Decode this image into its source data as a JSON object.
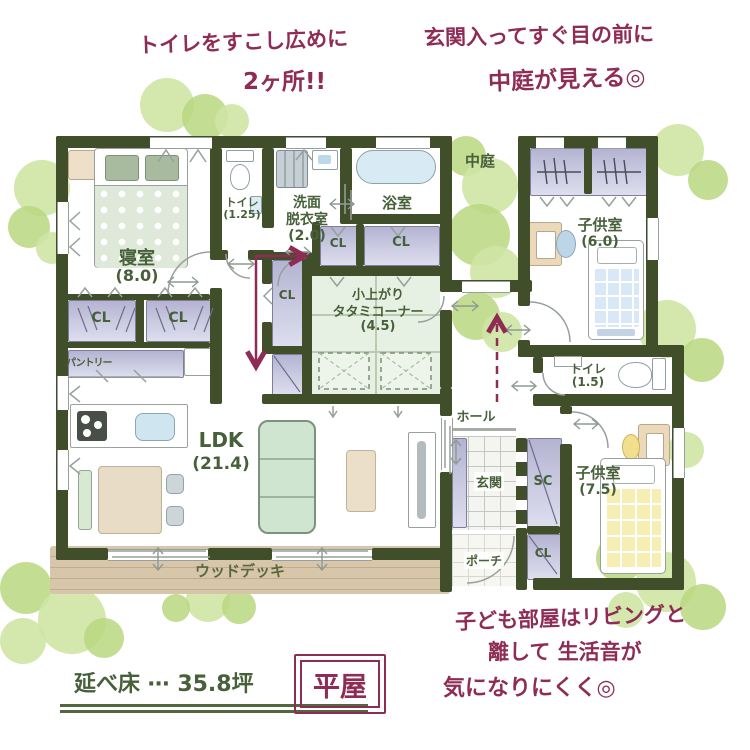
{
  "annotations": {
    "toilet_note": {
      "line1": "トイレをすこし広めに",
      "line2": "2ヶ所!!"
    },
    "entrance_note": {
      "line1": "玄関入ってすぐ目の前に",
      "line2": "中庭が見える◎"
    },
    "kids_note": {
      "line1": "子ども部屋はリビングと",
      "line2": "離して 生活音が",
      "line3": "気になりにくく◎"
    },
    "floor_area": "延べ床 ⋯ 35.8坪",
    "house_type": "平屋"
  },
  "rooms": {
    "bedroom": {
      "name": "寝室",
      "size": "(8.0)"
    },
    "toilet_1": {
      "name": "トイレ",
      "size": "(1.25)"
    },
    "washroom": {
      "line1": "洗面",
      "line2": "脱衣室",
      "size": "(2.0)"
    },
    "bathroom": {
      "name": "浴室"
    },
    "courtyard": {
      "name": "中庭"
    },
    "kids_room_1": {
      "name": "子供室",
      "size": "(6.0)"
    },
    "tatami_corner": {
      "line1": "小上がり",
      "line2": "タタミコーナー",
      "size": "(4.5)"
    },
    "pantry": {
      "name": "パントリー"
    },
    "ldk": {
      "name": "LDK",
      "size": "(21.4)"
    },
    "hall": {
      "name": "ホール"
    },
    "entrance": {
      "name": "玄関"
    },
    "shoe_closet": {
      "name": "SC"
    },
    "porch": {
      "name": "ポーチ"
    },
    "toilet_2": {
      "name": "トイレ",
      "size": "(1.5)"
    },
    "kids_room_2": {
      "name": "子供室",
      "size": "(7.5)"
    },
    "wood_deck": {
      "name": "ウッドデッキ"
    },
    "closet": {
      "label": "CL"
    }
  },
  "colors": {
    "wall": "#414e2a",
    "room_label_green": "#47603a",
    "annotation_maroon": "#8e2c55",
    "closet_lavender": "#c9c9e0",
    "tatami_green": "#e7f1e3",
    "foliage_green": "#bfdc8e",
    "wood_tan": "#d8c6aa"
  }
}
